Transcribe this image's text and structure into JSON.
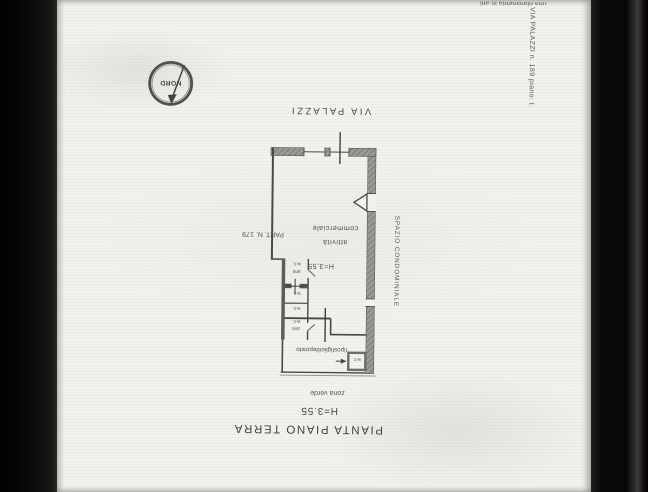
{
  "document": {
    "corner_note": "una planimetria in atti",
    "margin_note": "VIA PALAZZI n. 189 piano: t.",
    "title": "PIANTA PIANO TERRA",
    "height_note": "H=3.55",
    "green_zone_label": "zona verde",
    "street_label": "VIA PALAZZI",
    "parcel_label": "PART. N. 179",
    "condo_space_label": "SPAZIO CONDOMINIALE",
    "compass_label": "NORD"
  },
  "plan": {
    "main_room_line1": "attività",
    "main_room_line2": "commerciale",
    "main_room_height": "H=3.55",
    "storage_label": "ripostiglio/deposito",
    "wc_small_label": "w.c.",
    "rooms": [
      {
        "l1": "anti",
        "l2": "w.c."
      },
      {
        "l1": "w.c.",
        "l2": ""
      },
      {
        "l1": "w.c.",
        "l2": ""
      },
      {
        "l1": "anti",
        "l2": "w.c."
      }
    ]
  },
  "colors": {
    "paper": "#f2f1ed",
    "ink": "#4a4945",
    "wall_fill": "#9b9a95"
  }
}
